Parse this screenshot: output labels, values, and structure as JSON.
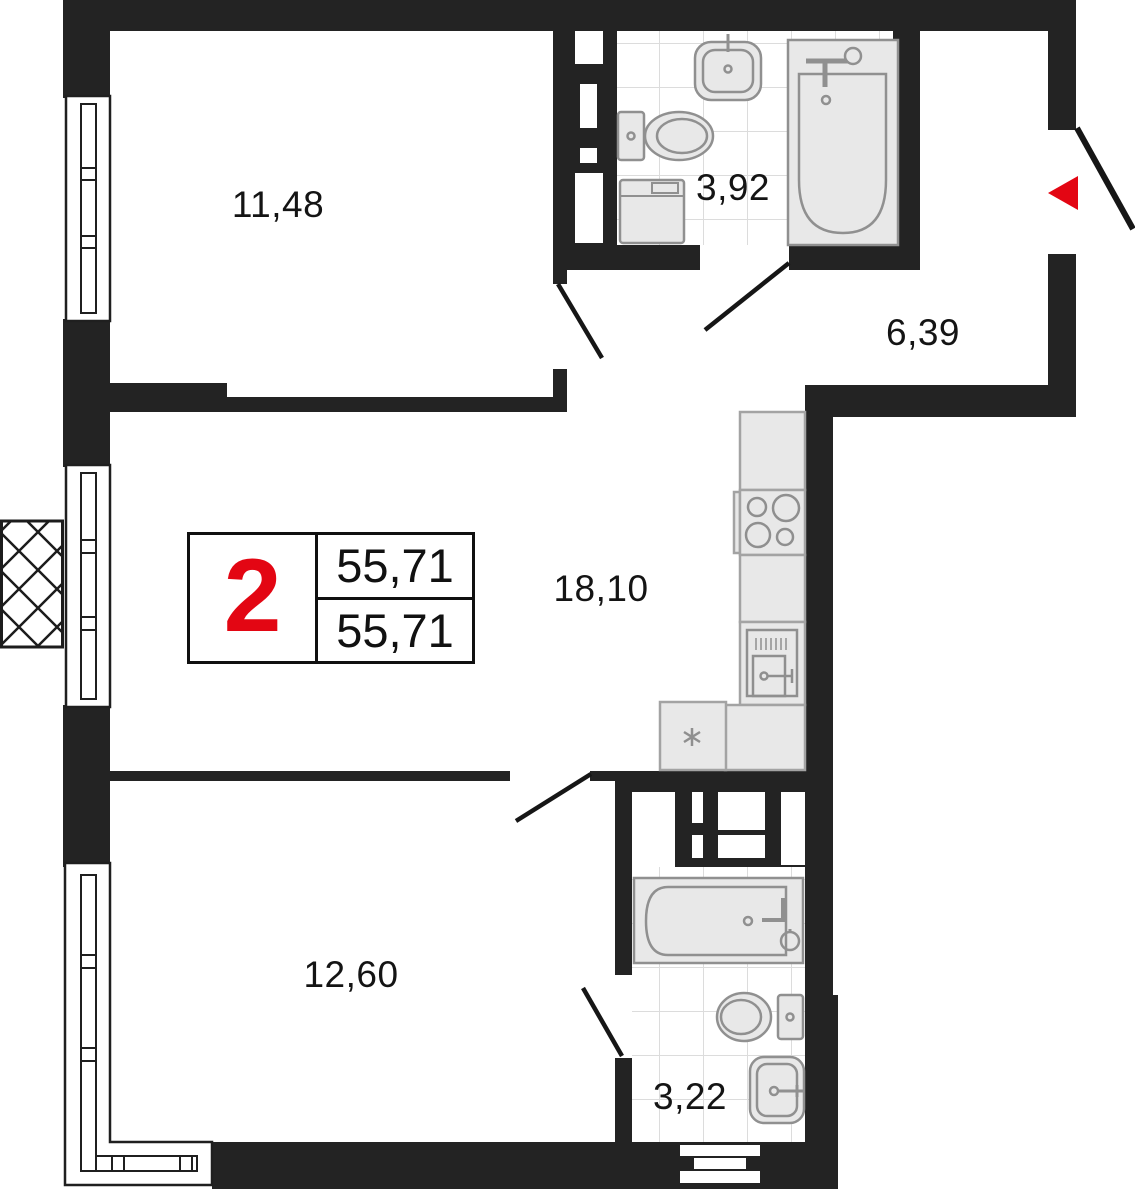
{
  "plan": {
    "title": "2-room apartment floor plan",
    "badge": {
      "rooms_count": "2",
      "total_area": "55,71",
      "living_area": "55,71"
    },
    "rooms": [
      {
        "name": "bedroom-top",
        "area": "11,48"
      },
      {
        "name": "bathroom-top",
        "area": "3,92"
      },
      {
        "name": "hallway",
        "area": "6,39"
      },
      {
        "name": "kitchen-living",
        "area": "18,10"
      },
      {
        "name": "bedroom-bottom",
        "area": "12,60"
      },
      {
        "name": "bathroom-bottom",
        "area": "3,22"
      }
    ],
    "fixtures": [
      "sink-icon",
      "toilet-icon",
      "washing-machine-icon",
      "bathtub-icon",
      "stove-icon",
      "kitchen-sink-icon",
      "fridge-icon"
    ],
    "colors": {
      "wall": "#232323",
      "accent_red": "#e30613",
      "fixture_fill": "#e8e8e8",
      "fixture_stroke": "#909090",
      "tile_line": "#dcdcdc",
      "text": "#141414"
    }
  }
}
